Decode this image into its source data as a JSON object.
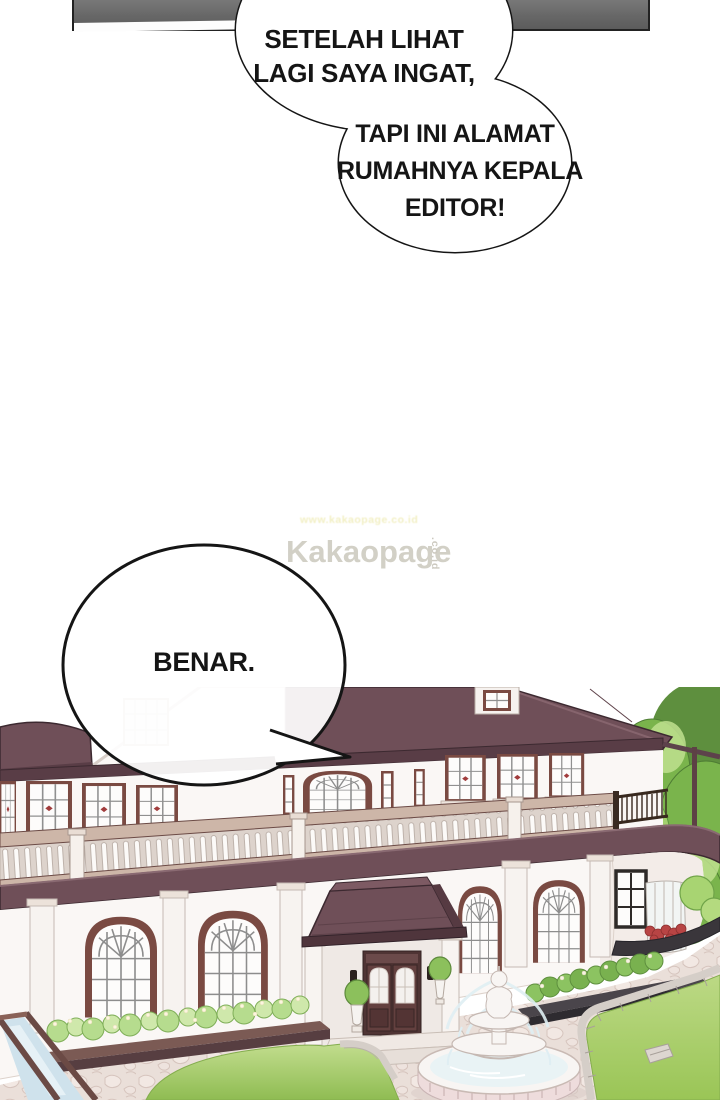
{
  "bubble_top": {
    "line1": "SETELAH LIHAT",
    "line2": "LAGI SAYA INGAT,",
    "line3": "TAPI INI ALAMAT",
    "line4": "RUMAHNYA KEPALA",
    "line5": "EDITOR!"
  },
  "bubble_reply": {
    "text": "BENAR."
  },
  "watermark": {
    "brand": "Kakaopage",
    "suffix": ".co.id",
    "faint_url": "www.kakaopage.co.id"
  },
  "illustration": {
    "scene": "Two-story classical mansion with balustraded balcony, arched windows, entrance portico, courtyard fountain, flower beds, topiary and trees"
  },
  "colors": {
    "panel": "#6a6a6a",
    "ink": "#151515",
    "roof": "#6f4f58",
    "roof_hi": "#7d5a63",
    "roof_dark": "#593d46",
    "roof_edge": "#3c2930",
    "wall": "#faf7f5",
    "wall_shade": "#f3ece8",
    "trim": "#c9bfb9",
    "frame": "#7a4a42",
    "frame_dark": "#4f3434",
    "door": "#63403f",
    "rail_light": "#cdb6a8",
    "green_dark": "#5e8f3e",
    "green_mid": "#7ab44c",
    "green_light": "#a2d06d",
    "green_hl": "#bfe08f",
    "bush_pale": "#cfe8ab",
    "bush_mid": "#b6dc8e",
    "lawn_a": "#8fbc52",
    "lawn_b": "#c2dd8e",
    "cobble": "#eadfd9",
    "cobble_line": "#d2bfb8",
    "stone": "#d5cec8",
    "water": "#cfe2ec",
    "fountain": "#f8f5f3",
    "fountain_pink": "#eedcdc",
    "planter_dark": "#3a363b",
    "planter_brown": "#6b4a45",
    "flower_red": "#b84444",
    "accent_red": "#a13c3c",
    "black_frame": "#2e2a28",
    "watermark_gray": "#d2d0c6",
    "watermark_faint": "#e7e293"
  }
}
